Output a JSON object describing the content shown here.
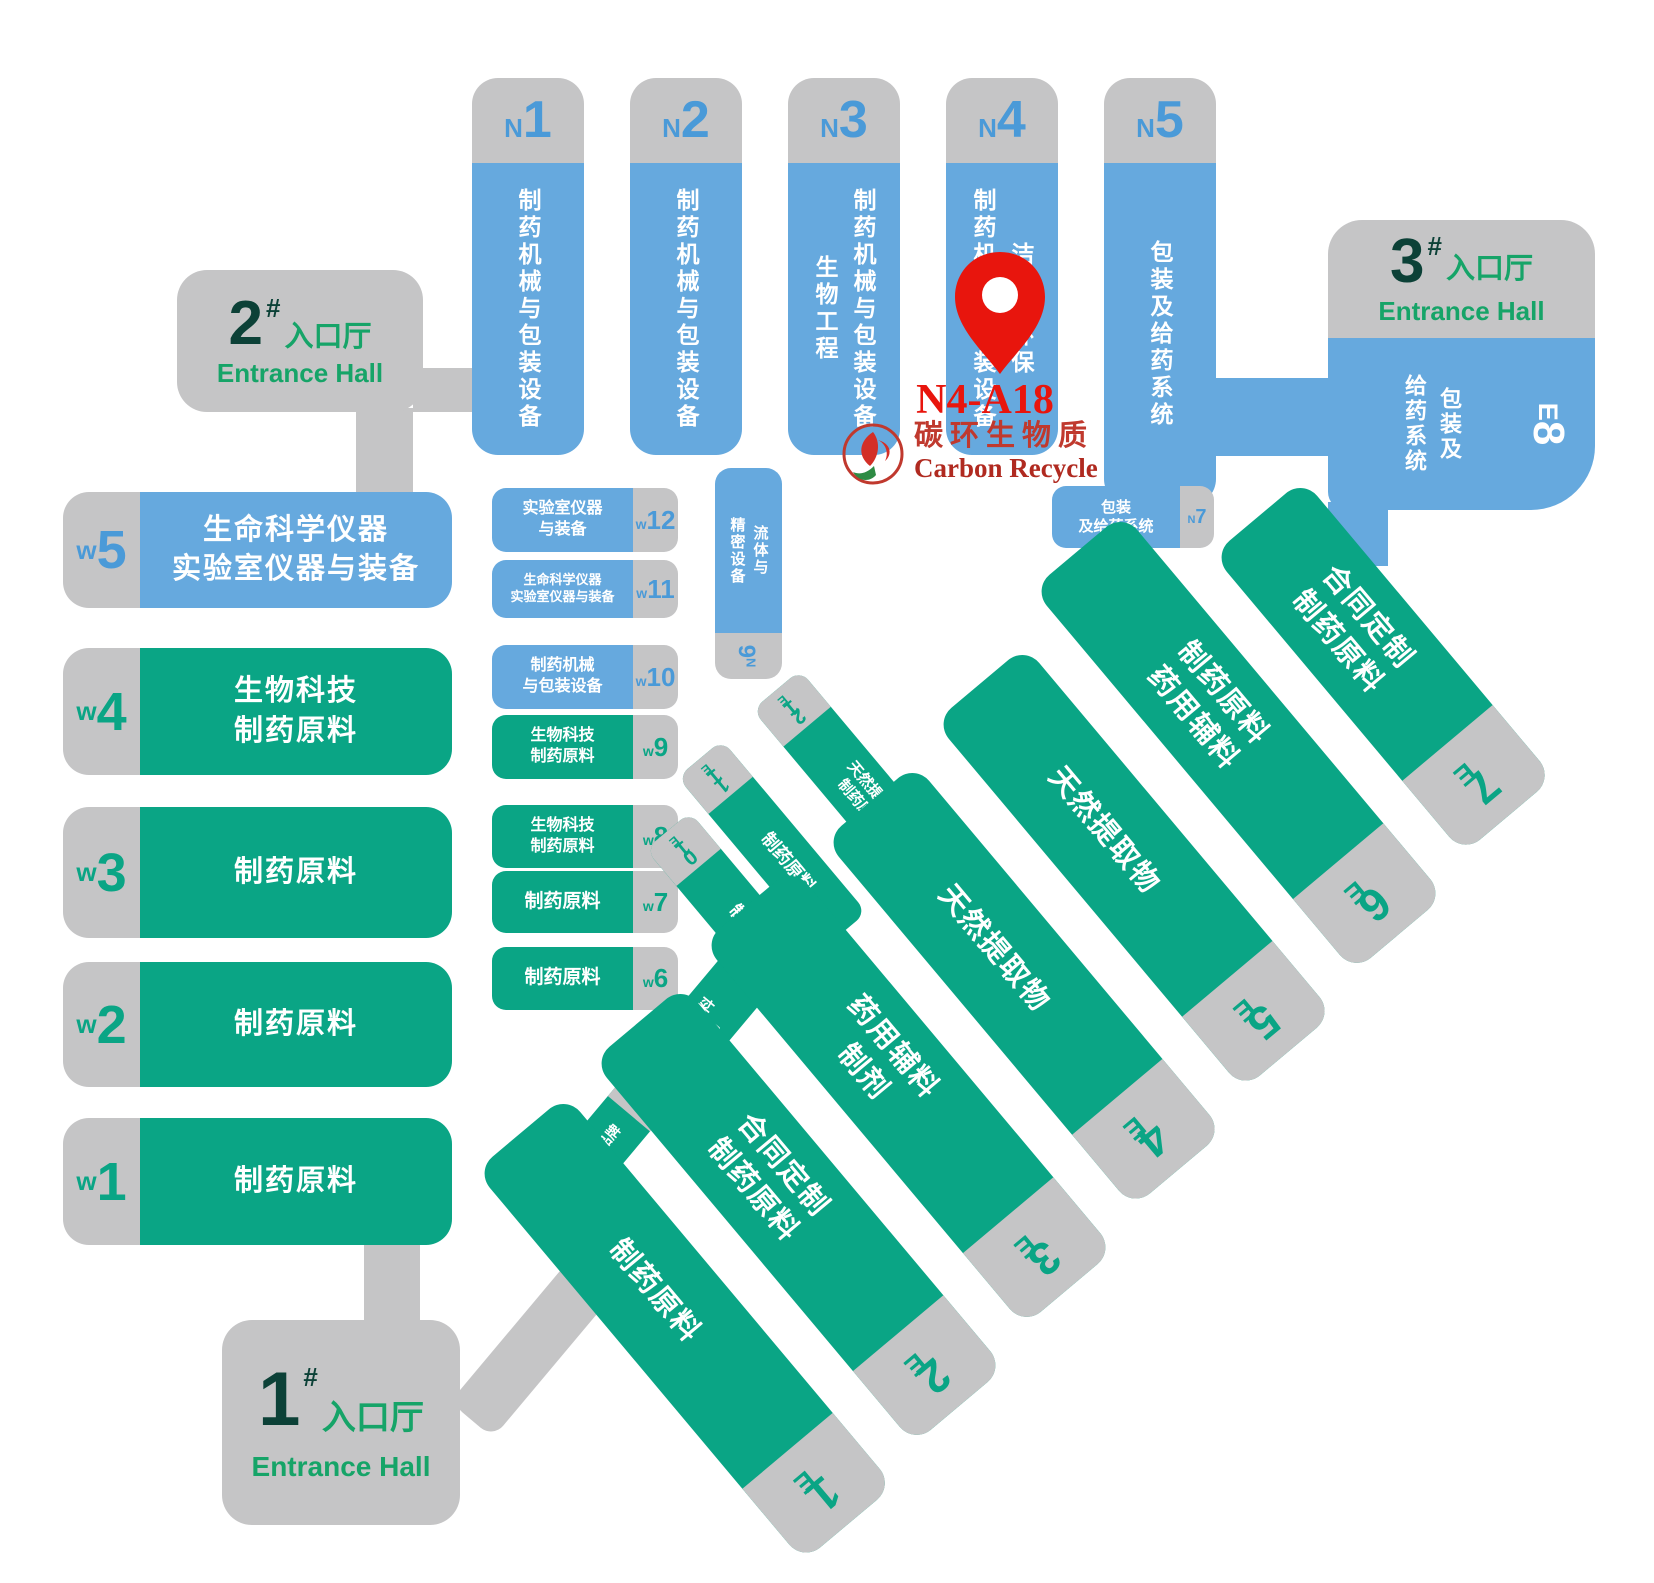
{
  "colors": {
    "blue": "#66a9de",
    "green": "#0aa585",
    "gray": "#c5c5c6",
    "codeblue": "#4a9ad8",
    "dark": "#0c4137",
    "entgreen": "#16a468",
    "red": "#e8150d",
    "darkred": "#b02a20"
  },
  "entrances": [
    {
      "num": "1",
      "hash": "#",
      "cn": "入口厅",
      "en": "Entrance Hall"
    },
    {
      "num": "2",
      "hash": "#",
      "cn": "入口厅",
      "en": "Entrance Hall"
    },
    {
      "num": "3",
      "hash": "#",
      "cn": "入口厅",
      "en": "Entrance Hall"
    }
  ],
  "n_halls": [
    {
      "p": "N",
      "n": "1",
      "lines": [
        "制药机械与包装设备"
      ]
    },
    {
      "p": "N",
      "n": "2",
      "lines": [
        "制药机械与包装设备"
      ]
    },
    {
      "p": "N",
      "n": "3",
      "lines": [
        "制药机械与包装设备",
        "生物工程"
      ]
    },
    {
      "p": "N",
      "n": "4",
      "lines": [
        "洁净与环保",
        "制药机械与包装设备"
      ]
    },
    {
      "p": "N",
      "n": "5",
      "lines": [
        "包装及给药系统"
      ]
    }
  ],
  "n6": {
    "code": "N6",
    "lines": [
      "流体与",
      "精密设备"
    ]
  },
  "n7": {
    "p": "N",
    "n": "7",
    "lines": [
      "包装",
      "及给药系统"
    ]
  },
  "e8": {
    "code": "E8",
    "lines": [
      "包装及",
      "给药系统"
    ]
  },
  "w_large": [
    {
      "p": "w",
      "n": "5",
      "lines": [
        "生命科学仪器",
        "实验室仪器与装备"
      ]
    },
    {
      "p": "w",
      "n": "4",
      "lines": [
        "生物科技",
        "制药原料"
      ]
    },
    {
      "p": "w",
      "n": "3",
      "lines": [
        "制药原料"
      ]
    },
    {
      "p": "w",
      "n": "2",
      "lines": [
        "制药原料"
      ]
    },
    {
      "p": "w",
      "n": "1",
      "lines": [
        "制药原料"
      ]
    }
  ],
  "w_small": [
    {
      "p": "w",
      "n": "12",
      "lines": [
        "实验室仪器",
        "与装备"
      ]
    },
    {
      "p": "w",
      "n": "11",
      "lines": [
        "生命科学仪器",
        "实验室仪器与装备"
      ]
    },
    {
      "p": "w",
      "n": "10",
      "lines": [
        "制药机械",
        "与包装设备"
      ]
    },
    {
      "p": "w",
      "n": "9",
      "lines": [
        "生物科技",
        "制药原料"
      ]
    },
    {
      "p": "w",
      "n": "8",
      "lines": [
        "生物科技",
        "制药原料"
      ]
    },
    {
      "p": "w",
      "n": "7",
      "lines": [
        "制药原料"
      ]
    },
    {
      "p": "w",
      "n": "6",
      "lines": [
        "制药原料"
      ]
    }
  ],
  "e_large": [
    {
      "code": "E1",
      "lines": [
        "制药原料"
      ]
    },
    {
      "code": "E2",
      "lines": [
        "合同定制",
        "制药原料"
      ]
    },
    {
      "code": "E3",
      "lines": [
        "药用辅料",
        "制剂"
      ]
    },
    {
      "code": "E4",
      "lines": [
        "天然提取物"
      ]
    },
    {
      "code": "E5",
      "lines": [
        "天然提取物"
      ]
    },
    {
      "code": "E6",
      "lines": [
        "制药原料",
        "药用辅料"
      ]
    },
    {
      "code": "E7",
      "lines": [
        "合同定制",
        "制药原料"
      ]
    }
  ],
  "e_small": [
    {
      "code": "E12",
      "lines": [
        "天然提取物",
        "制药原料"
      ]
    },
    {
      "code": "E11",
      "lines": [
        "制药原料"
      ]
    },
    {
      "code": "E10",
      "lines": [
        "制药原料"
      ]
    },
    {
      "code": "E9",
      "lines": [
        "制药原料",
        "制剂"
      ]
    },
    {
      "code": "E13",
      "lines": [
        "国际品牌"
      ]
    }
  ],
  "marker": {
    "code": "N4-A18"
  },
  "logo": {
    "cn": "碳环生物质",
    "en": "Carbon Recycle"
  }
}
